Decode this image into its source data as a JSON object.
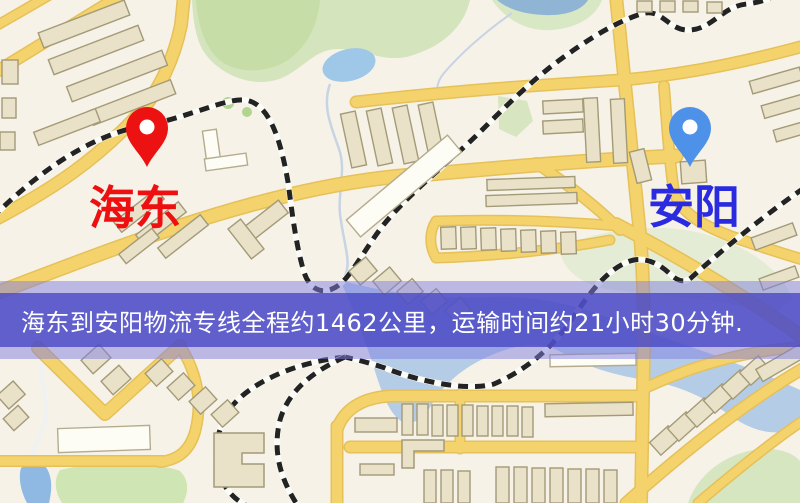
{
  "map": {
    "origin_marker": {
      "label": "海东",
      "label_color": "#ee1010",
      "pin_color": "#ed1212"
    },
    "destination_marker": {
      "label": "安阳",
      "label_color": "#2a2ae0",
      "pin_color": "#4d92e8"
    }
  },
  "banner": {
    "text": "海东到安阳物流专线全程约1462公里，运输时间约21小时30分钟.",
    "text_color": "#ffffff",
    "band_color": "#4a48c4"
  },
  "colors": {
    "map_background": "#f6f2e8",
    "road_yellow": "#f5d36c",
    "park_green": "#d4e4bd",
    "water_blue": "#a9c6e6",
    "railway_dash": "#232323"
  }
}
